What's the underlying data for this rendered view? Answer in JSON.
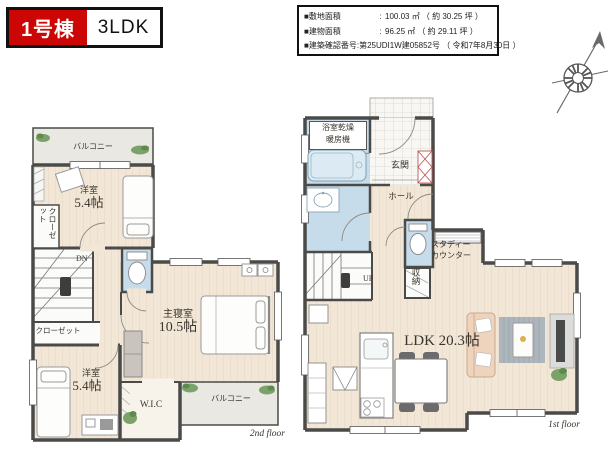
{
  "header": {
    "badge": {
      "number": "1号棟",
      "layout": "3LDK"
    },
    "info": {
      "separator": ":",
      "rows": [
        {
          "label": "■敷地面積",
          "value": "100.03 ㎡ （ 約 30.25 坪 ）"
        },
        {
          "label": "■建物面積",
          "value": "96.25 ㎡ （ 約 29.11 坪 ）"
        },
        {
          "label": "■建築確認番号",
          "value": "第25UDI1W建05852号 （ 令和7年8月30日 ）"
        }
      ]
    }
  },
  "compass": {
    "icon": "north-compass"
  },
  "second_floor": {
    "caption": "2nd floor",
    "balcony_top": "バルコニー",
    "bedroom_a_name": "洋室",
    "bedroom_a_size": "5.4帖",
    "closet_vertical": "クローゼット",
    "stairs_label": "DN",
    "closet_lower": "クローゼット",
    "bedroom_b_name": "洋室",
    "bedroom_b_size": "5.4帖",
    "master_name": "主寝室",
    "master_size": "10.5帖",
    "wic": "W.I.C",
    "balcony_bottom": "バルコニー"
  },
  "first_floor": {
    "caption": "1st floor",
    "bath_heater_line1": "浴室乾燥",
    "bath_heater_line2": "暖房機",
    "entrance": "玄関",
    "hall": "ホール",
    "stairs_label": "UP",
    "storage": "収納",
    "study_line1": "スタディー",
    "study_line2": "カウンター",
    "ldk": "LDK 20.3帖"
  }
}
